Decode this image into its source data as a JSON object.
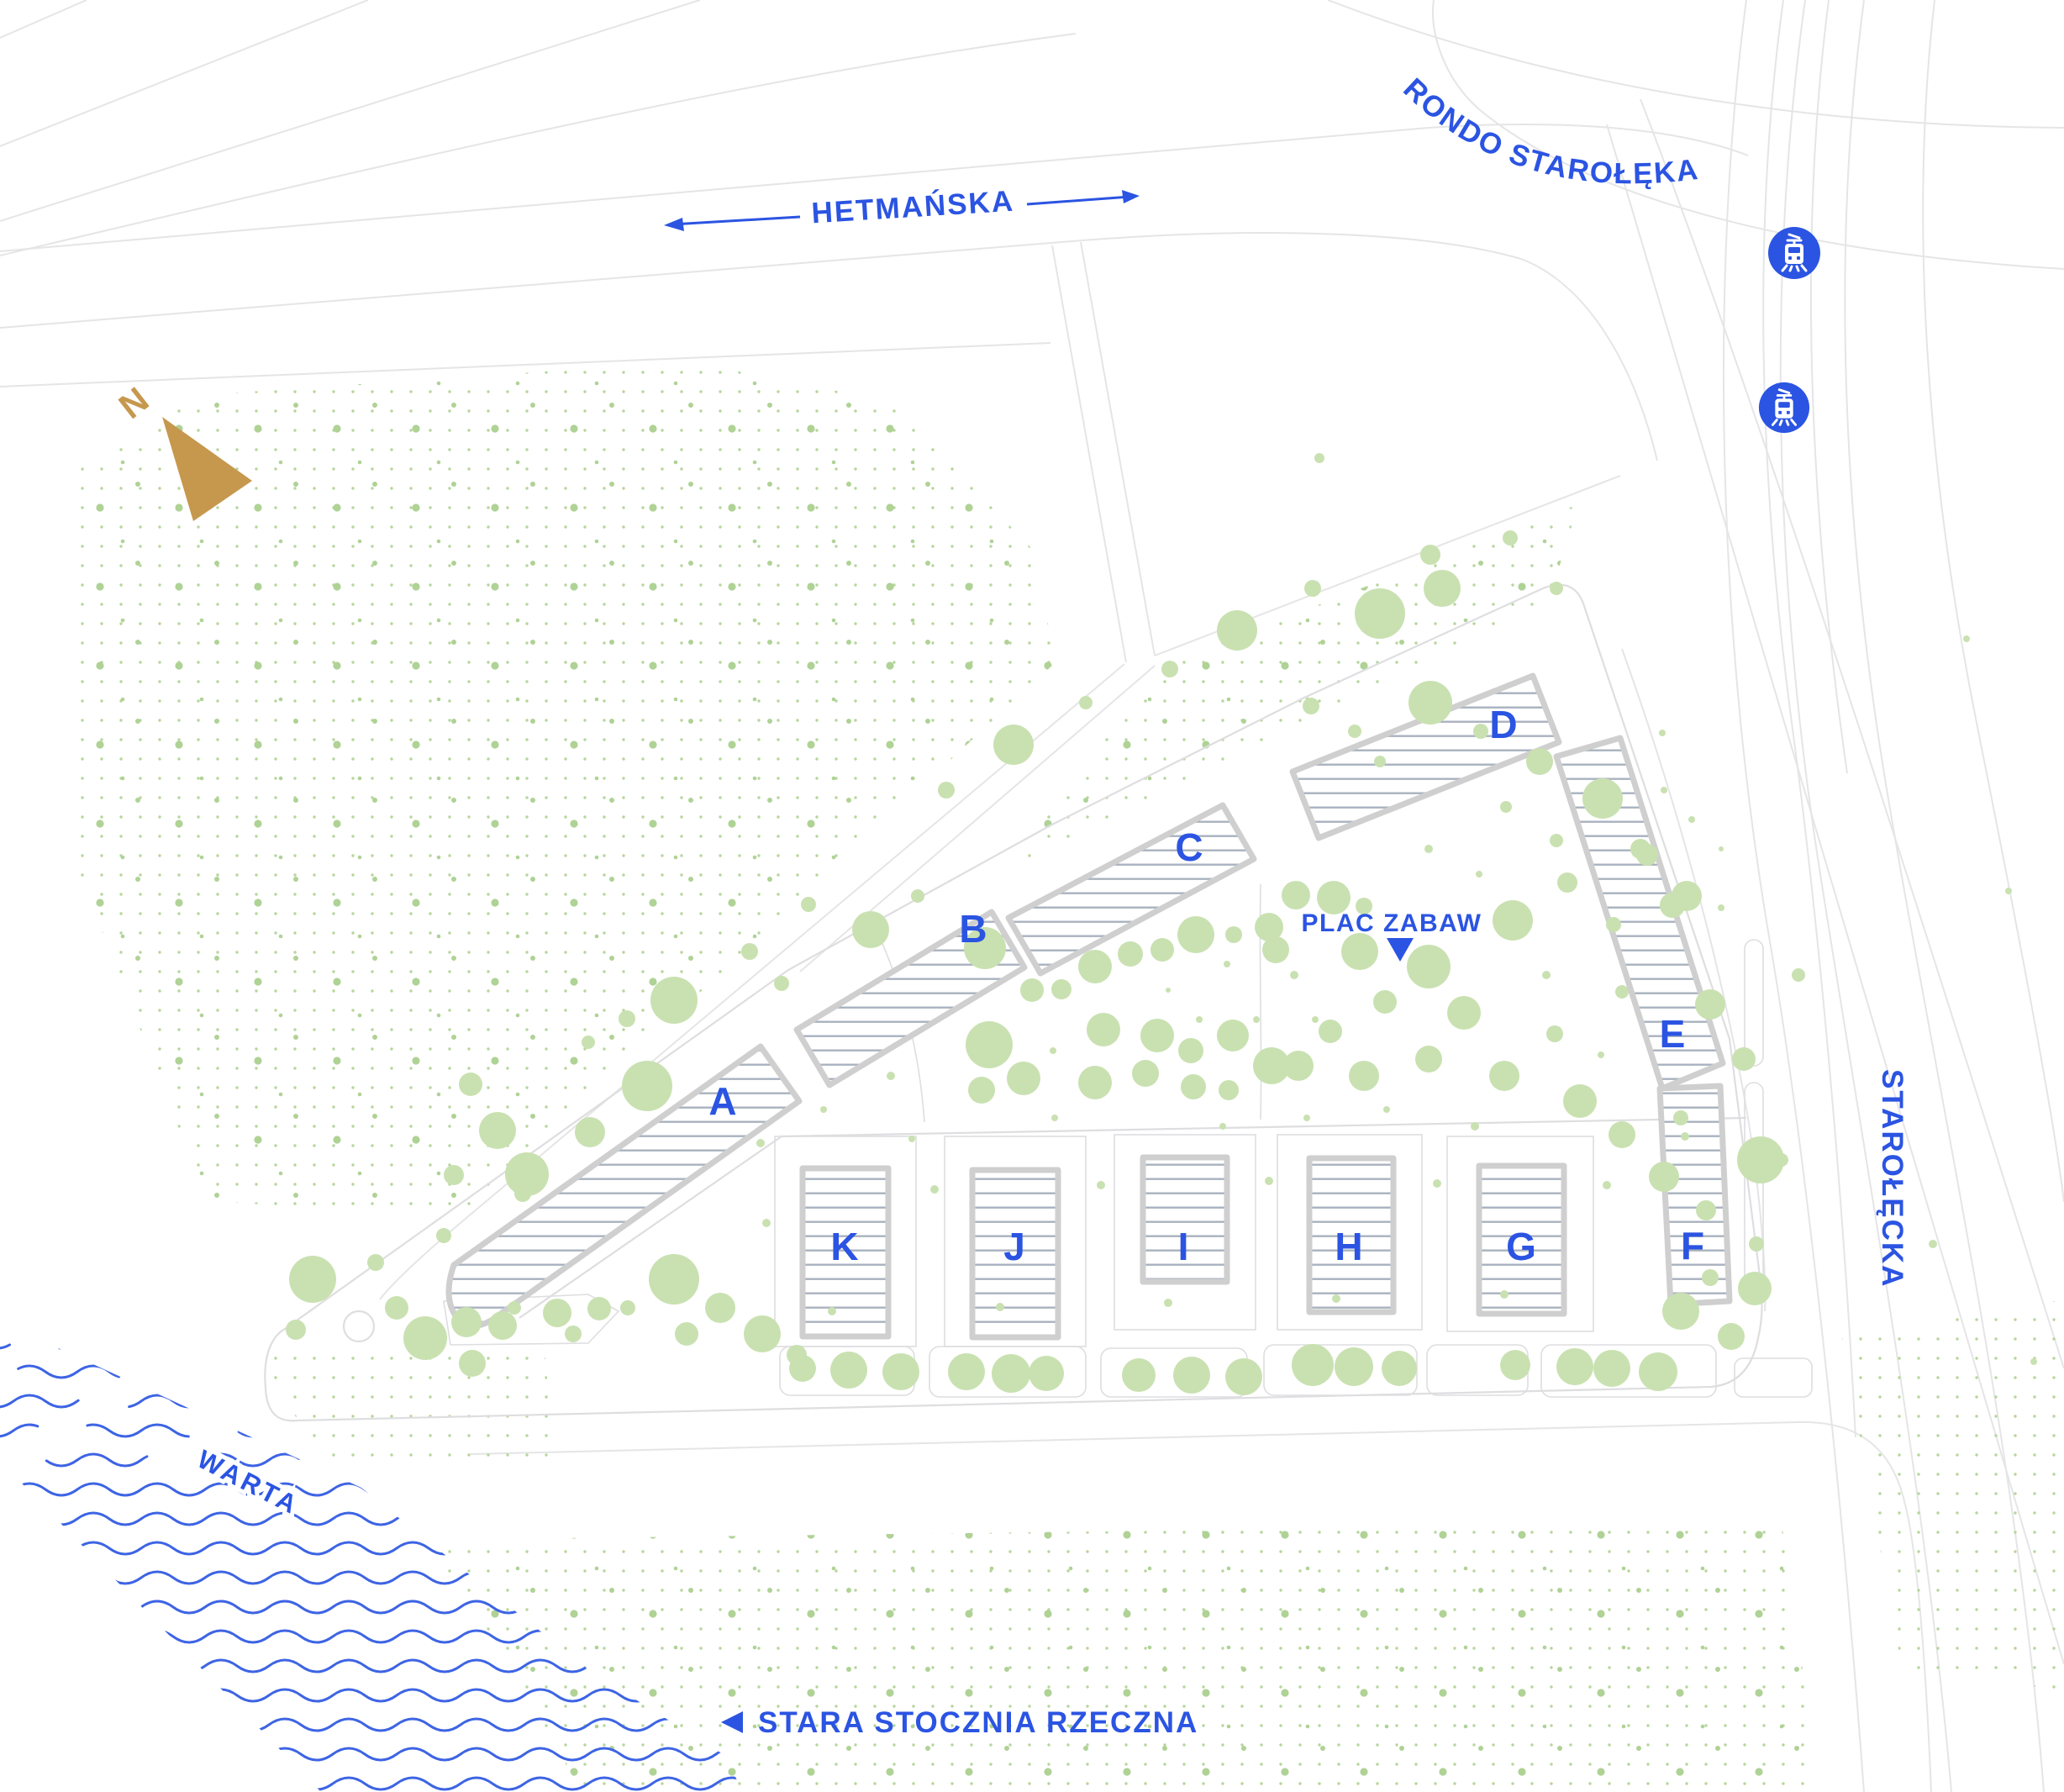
{
  "labels": {
    "hetmanska": "HETMAŃSKA",
    "rondo": "RONDO STAROŁĘKA",
    "starolecka": "STAROŁĘCKA",
    "warta": "WARTA",
    "stara_stocznia": "STARA STOCZNIA RZECZNA",
    "plac_zabaw": "PLAC ZABAW",
    "north": "N"
  },
  "buildings": {
    "a": "A",
    "b": "B",
    "c": "C",
    "d": "D",
    "e": "E",
    "f": "F",
    "g": "G",
    "h": "H",
    "i": "I",
    "j": "J",
    "k": "K"
  },
  "icons": {
    "tram": "tram-icon",
    "north_arrow": "north-arrow",
    "playground_marker": "triangle-down-marker",
    "street_direction": "double-arrow"
  },
  "colors": {
    "label_blue": "#2B54E2",
    "tram_blue": "#2B54E2",
    "water_blue": "#3D64E4",
    "tree_green": "#C9E1B1",
    "dot_green": "#B7D69B",
    "dot_green_dark": "#AFD295",
    "gold": "#C6984E",
    "building_outline": "#CFCFCF",
    "hatch_line": "#A9B2BF",
    "road_gray": "#E5E5E7",
    "site_gray": "#DEDEE1"
  }
}
